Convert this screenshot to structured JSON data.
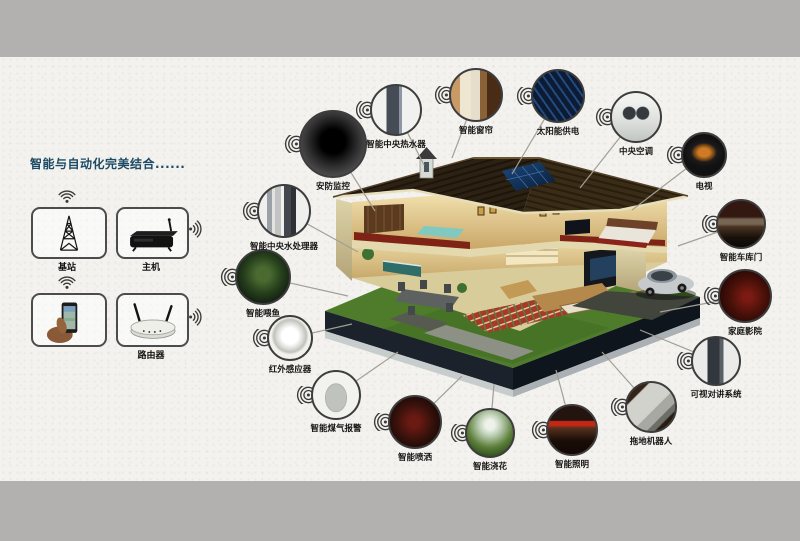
{
  "title": {
    "text": "智能与自动化完美结合......"
  },
  "colors": {
    "background": "#f3f2ee",
    "band": "#b2b1af",
    "title": "#1c4a63",
    "leader_line": "#a29f95",
    "circle_border": "#3d3d3d",
    "label": "#161616"
  },
  "network_panel": {
    "items": [
      {
        "id": "base-station",
        "label": "基站",
        "icon": "antenna-tower-icon",
        "wifi": "top"
      },
      {
        "id": "host",
        "label": "主机",
        "icon": "set-top-box-icon",
        "wifi": "right"
      },
      {
        "id": "phone",
        "label": "",
        "icon": "smartphone-hand-icon",
        "wifi": "top"
      },
      {
        "id": "router",
        "label": "路由器",
        "icon": "wireless-router-icon",
        "wifi": "right"
      }
    ]
  },
  "devices": [
    {
      "id": "water-processor",
      "label": "智能中央水处理器",
      "cx": 284,
      "cy": 211,
      "r": 27,
      "target": [
        358,
        252
      ]
    },
    {
      "id": "fish-feeder",
      "label": "智能喂鱼",
      "cx": 263,
      "cy": 277,
      "r": 28,
      "target": [
        348,
        296
      ]
    },
    {
      "id": "infrared-sensor",
      "label": "红外感应器",
      "cx": 290,
      "cy": 338,
      "r": 23,
      "target": [
        352,
        324
      ]
    },
    {
      "id": "gas-alarm",
      "label": "智能煤气报警",
      "cx": 336,
      "cy": 395,
      "r": 25,
      "target": [
        398,
        352
      ]
    },
    {
      "id": "smart-spray",
      "label": "智能喷洒",
      "cx": 415,
      "cy": 422,
      "r": 27,
      "target": [
        462,
        376
      ]
    },
    {
      "id": "sprinkler",
      "label": "智能浇花",
      "cx": 490,
      "cy": 433,
      "r": 25,
      "target": [
        494,
        384
      ]
    },
    {
      "id": "smart-lighting",
      "label": "智能照明",
      "cx": 572,
      "cy": 430,
      "r": 26,
      "target": [
        556,
        370
      ]
    },
    {
      "id": "mopping-robot",
      "label": "拖地机器人",
      "cx": 651,
      "cy": 407,
      "r": 26,
      "target": [
        602,
        352
      ]
    },
    {
      "id": "video-intercom",
      "label": "可视对讲系统",
      "cx": 716,
      "cy": 361,
      "r": 25,
      "target": [
        640,
        330
      ]
    },
    {
      "id": "home-theater",
      "label": "家庭影院",
      "cx": 745,
      "cy": 296,
      "r": 27,
      "target": [
        660,
        312
      ]
    },
    {
      "id": "garage-door",
      "label": "智能车库门",
      "cx": 741,
      "cy": 224,
      "r": 25,
      "target": [
        678,
        246
      ]
    },
    {
      "id": "tv",
      "label": "电视",
      "cx": 704,
      "cy": 155,
      "r": 23,
      "target": [
        632,
        210
      ]
    },
    {
      "id": "central-ac",
      "label": "中央空调",
      "cx": 636,
      "cy": 117,
      "r": 26,
      "target": [
        580,
        188
      ]
    },
    {
      "id": "solar-power",
      "label": "太阳能供电",
      "cx": 558,
      "cy": 96,
      "r": 27,
      "target": [
        512,
        174
      ]
    },
    {
      "id": "smart-curtain",
      "label": "智能窗帘",
      "cx": 476,
      "cy": 95,
      "r": 27,
      "target": [
        452,
        158
      ]
    },
    {
      "id": "water-heater",
      "label": "智能中央热水器",
      "cx": 396,
      "cy": 110,
      "r": 26,
      "target": [
        424,
        165
      ]
    },
    {
      "id": "security-camera",
      "label": "安防监控",
      "cx": 333,
      "cy": 144,
      "r": 34,
      "target": [
        375,
        211
      ]
    }
  ]
}
